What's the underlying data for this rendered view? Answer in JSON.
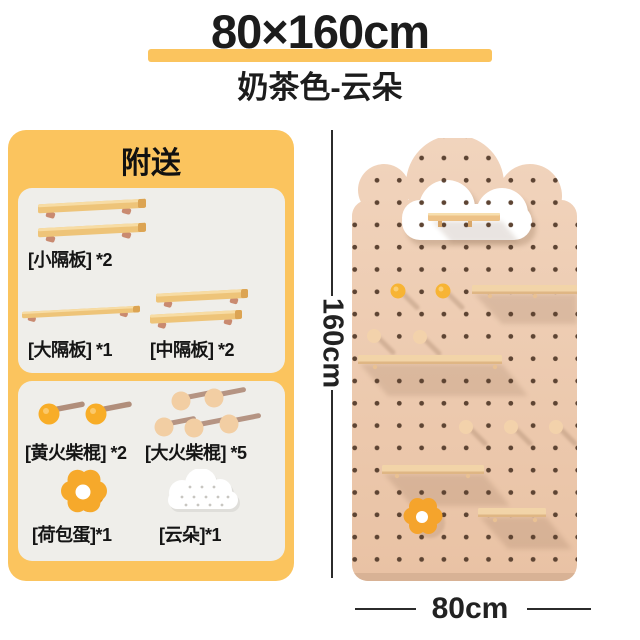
{
  "header": {
    "title": "80×160cm",
    "subtitle": "奶茶色-云朵"
  },
  "gifts": {
    "title": "附送",
    "items": [
      {
        "name": "small-shelf",
        "label": "[小隔板] *2"
      },
      {
        "name": "large-shelf",
        "label": "[大隔板] *1"
      },
      {
        "name": "medium-shelf",
        "label": "[中隔板] *2"
      },
      {
        "name": "yellow-matchstick",
        "label": "[黄火柴棍] *2"
      },
      {
        "name": "large-matchstick",
        "label": "[大火柴棍] *5"
      },
      {
        "name": "fried-egg",
        "label": "[荷包蛋]*1"
      },
      {
        "name": "cloud",
        "label": "[云朵]*1"
      }
    ]
  },
  "dimensions": {
    "height": "160cm",
    "width": "80cm"
  },
  "colors": {
    "accent_yellow": "#FBC45E",
    "card_gray": "#EFEEEA",
    "board_tan": "#ECCBAE",
    "hole_brown": "#5D4433",
    "wood": "#EEC488",
    "peg_yellow": "#F7B434",
    "peg_wood": "#F3D2AB",
    "flower_orange": "#F5A42C",
    "text_black": "#1E1E1E"
  }
}
